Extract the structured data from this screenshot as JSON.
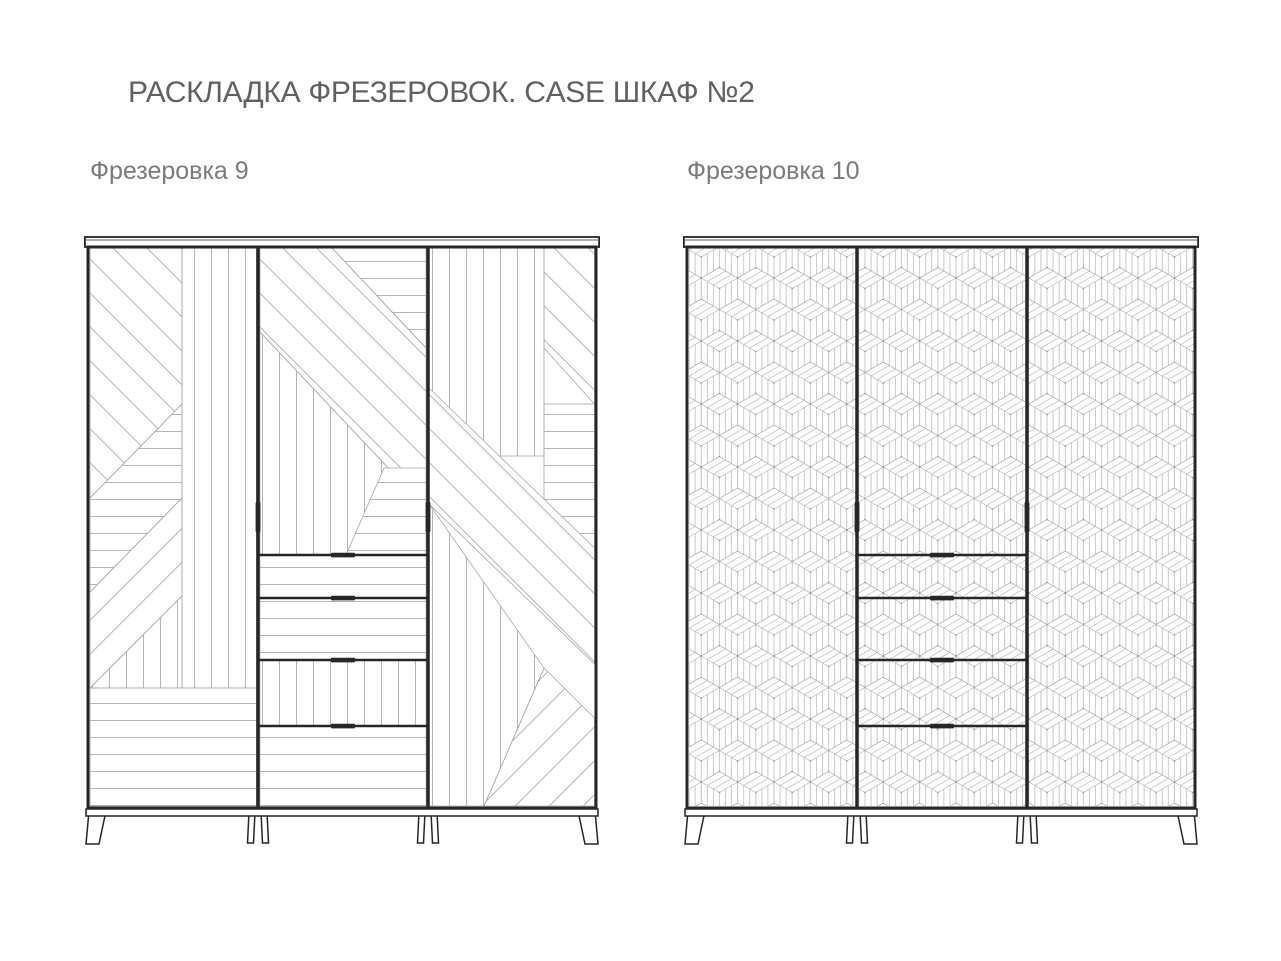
{
  "page": {
    "title": "РАСКЛАДКА ФРЕЗЕРОВОК. CASE ШКАФ №2",
    "background": "#ffffff"
  },
  "figures": [
    {
      "label": "Фрезеровка 9",
      "milling_number": 9,
      "pattern_style": "patchwork of straight milled strips: vertical, horizontal and 45-degree diagonal bands",
      "doors": 3,
      "drawers": 4,
      "drawer_patterns": [
        "horizontal",
        "horizontal",
        "vertical",
        "horizontal"
      ]
    },
    {
      "label": "Фрезеровка 10",
      "milling_number": 10,
      "pattern_style": "isometric cube (tumbling blocks) milling over all fronts",
      "doors": 3,
      "drawers": 4,
      "drawer_patterns": [
        "cube",
        "cube",
        "cube",
        "cube"
      ]
    }
  ],
  "colors": {
    "background": "#ffffff",
    "frame_line": "#262626",
    "milling_line": "#b5b5b7",
    "region_edge": "#a8a8aa",
    "title_text": "#616164",
    "label_text": "#7b7b7e"
  }
}
